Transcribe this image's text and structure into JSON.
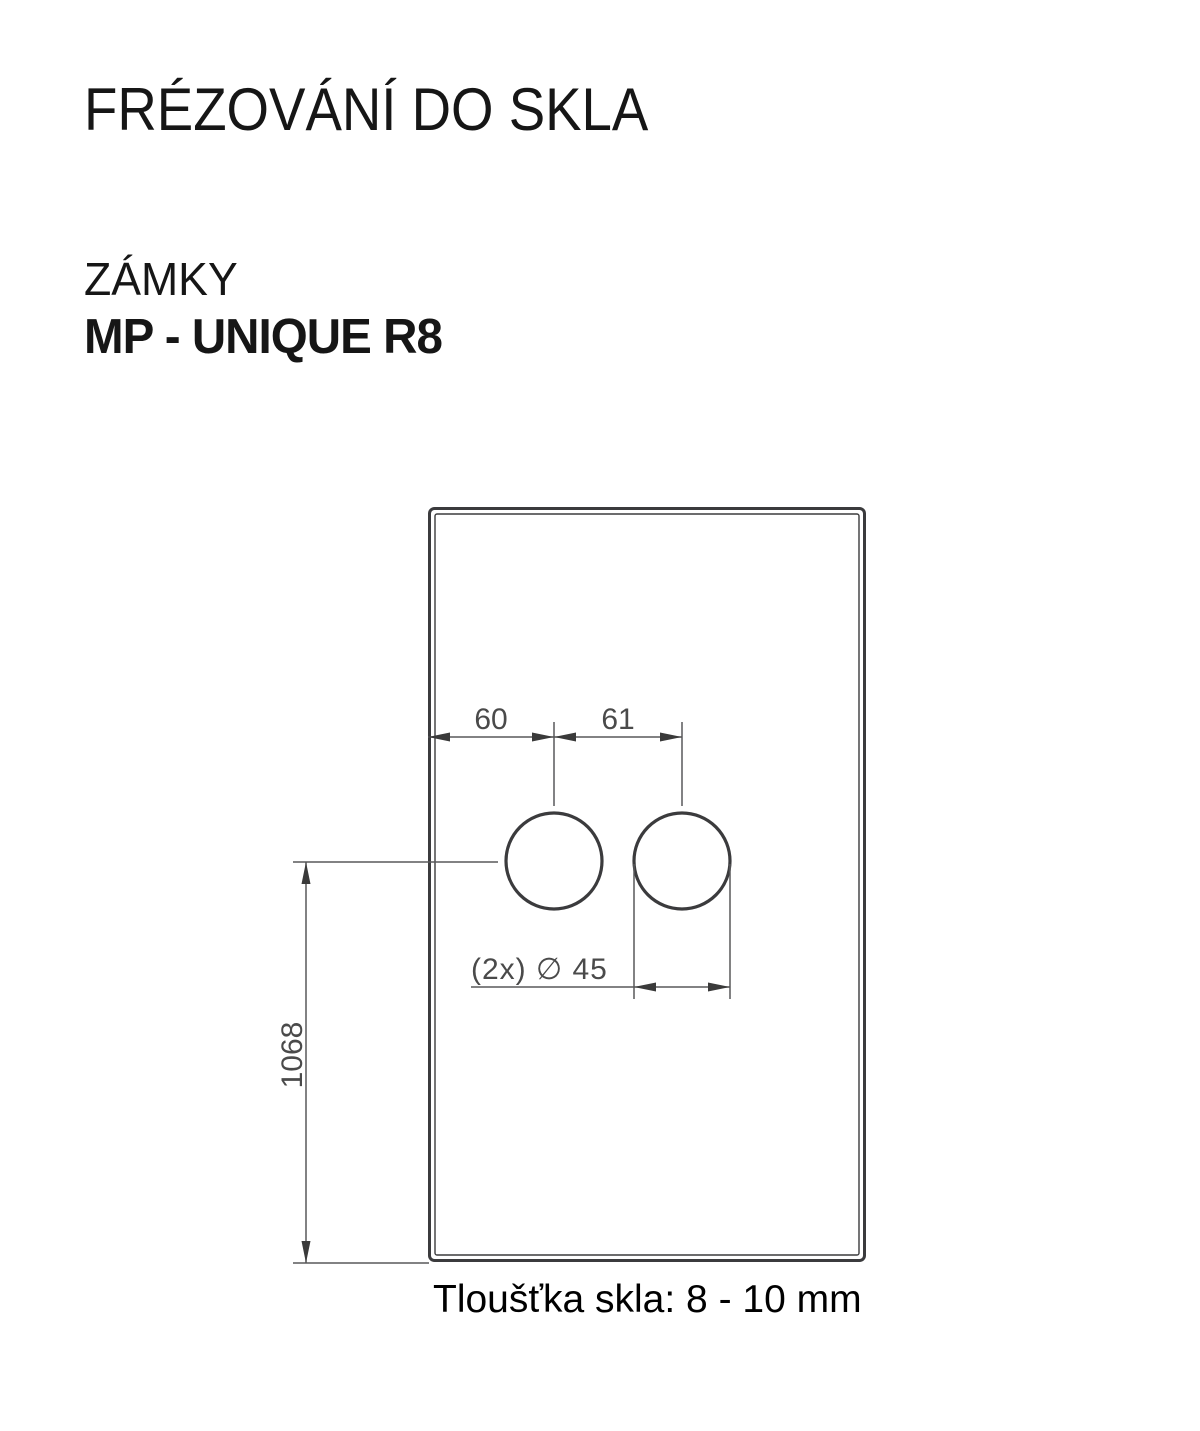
{
  "header": {
    "title": "FRÉZOVÁNÍ DO SKLA",
    "category": "ZÁMKY",
    "model": "MP - UNIQUE R8"
  },
  "drawing": {
    "dim_edge_to_hole": "60",
    "dim_hole_spacing": "61",
    "dim_hole_diameter": "(2x) ∅ 45",
    "dim_bottom_to_holes": "1068",
    "caption": "Tloušťka skla: 8 - 10 mm",
    "colors": {
      "outline": "#3b3b3d",
      "dimension_lines": "#58585a",
      "dimension_text": "#4a4a4a",
      "heading_text": "#161616",
      "caption_text": "#000000",
      "background": "#ffffff"
    }
  }
}
